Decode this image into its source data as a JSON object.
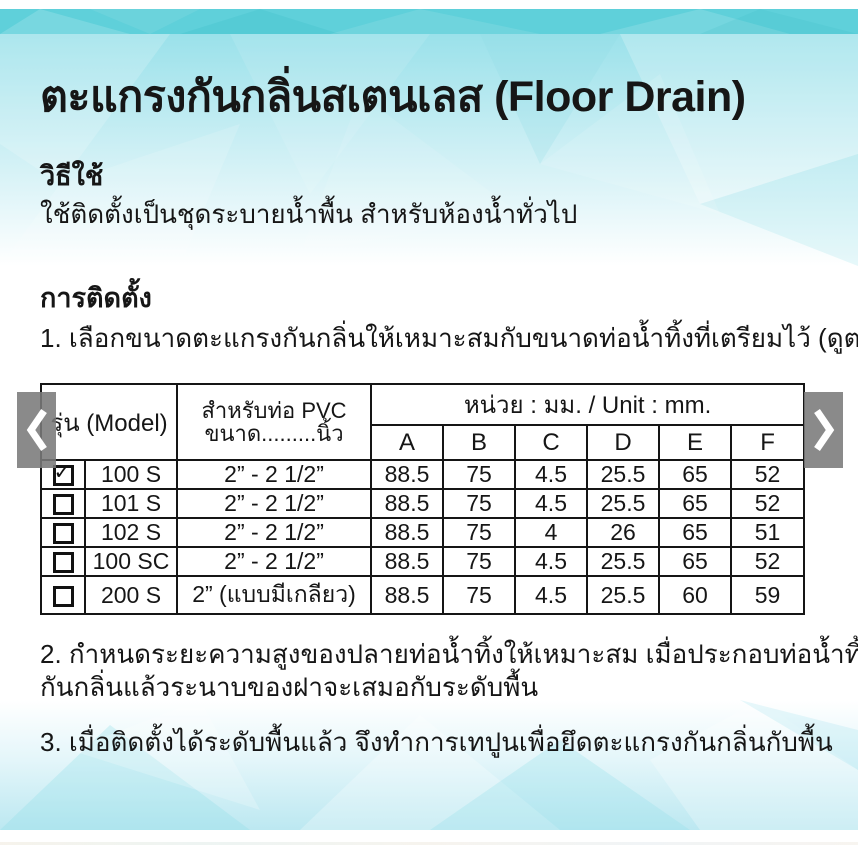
{
  "title": "ตะแกรงกันกลิ่นสเตนเลส (Floor Drain)",
  "sections": {
    "usage_heading": "วิธีใช้",
    "usage_text": "ใช้ติดตั้งเป็นชุดระบายน้ำพื้น สำหรับห้องน้ำทั่วไป",
    "install_heading": "การติดตั้ง",
    "step1": "1. เลือกขนาดตะแกรงกันกลิ่นให้เหมาะสมกับขนาดท่อน้ำทิ้งที่เตรียมไว้ (ดูตารางด้านล่าง)",
    "step2_line1": "2. กำหนดระยะความสูงของปลายท่อน้ำทิ้งให้เหมาะสม เมื่อประกอบท่อน้ำทิ้งกับตะแกรง",
    "step2_line2": "กันกลิ่นแล้วระนาบของฝาจะเสมอกับระดับพื้น",
    "step3": "3. เมื่อติดตั้งได้ระดับพื้นแล้ว จึงทำการเทปูนเพื่อยึดตะแกรงกันกลิ่นกับพื้น"
  },
  "table": {
    "model_header": "รุ่น (Model)",
    "pipe_header_line1": "สำหรับท่อ PVC",
    "pipe_header_line2": "ขนาด.........นิ้ว",
    "unit_header": "หน่วย : มม. / Unit : mm.",
    "dim_columns": [
      "A",
      "B",
      "C",
      "D",
      "E",
      "F"
    ],
    "check_glyph": "✓",
    "rows": [
      {
        "checked": true,
        "model": "100 S",
        "pipe": "2” - 2 1/2”",
        "dims": [
          "88.5",
          "75",
          "4.5",
          "25.5",
          "65",
          "52"
        ]
      },
      {
        "checked": false,
        "model": "101 S",
        "pipe": "2” - 2 1/2”",
        "dims": [
          "88.5",
          "75",
          "4.5",
          "25.5",
          "65",
          "52"
        ]
      },
      {
        "checked": false,
        "model": "102 S",
        "pipe": "2” - 2 1/2”",
        "dims": [
          "88.5",
          "75",
          "4",
          "26",
          "65",
          "51"
        ]
      },
      {
        "checked": false,
        "model": "100 SC",
        "pipe": "2” - 2 1/2”",
        "dims": [
          "88.5",
          "75",
          "4.5",
          "25.5",
          "65",
          "52"
        ]
      },
      {
        "checked": false,
        "model": "200 S",
        "pipe": "2” (แบบมีเกลียว)",
        "dims": [
          "88.5",
          "75",
          "4.5",
          "25.5",
          "60",
          "59"
        ]
      }
    ]
  },
  "carousel": {
    "prev_icon": "chevron-left",
    "next_icon": "chevron-right"
  },
  "colors": {
    "teal_band": "#5fd0da",
    "hero_cyan": "#b7e9f0",
    "bottom_cyan": "#bce8f1",
    "arrow_bg": "#7a7a7a",
    "border_black": "#151515"
  }
}
